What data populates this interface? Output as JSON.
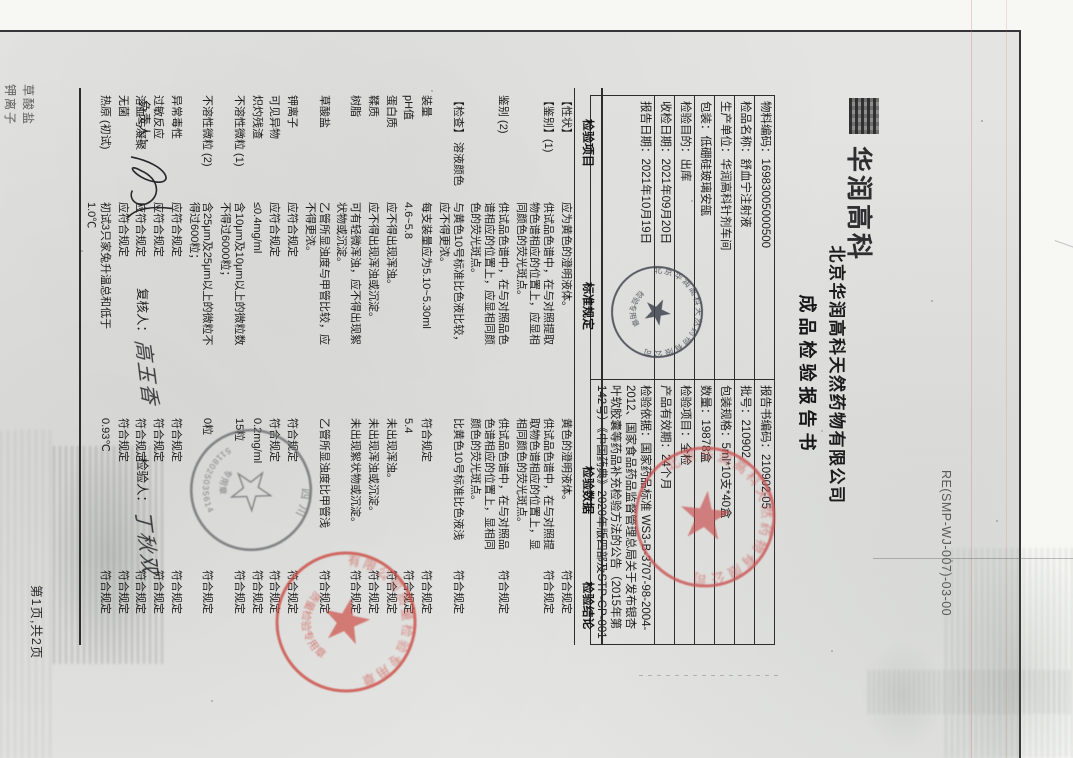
{
  "header": {
    "logo_text": "华润高科",
    "company": "北京华润高科天然药物有限公司",
    "report_title": "成品检验报告书",
    "doc_code": "RE(SMP-WJ-007)-03-00"
  },
  "info_table": {
    "rows": [
      {
        "left": "物料编码：16983005000500",
        "right": "报告书编码：210902-05"
      },
      {
        "left": "检品名称：舒血宁注射液",
        "right": "批号：210902"
      },
      {
        "left": "生产单位：华润高科针剂车间",
        "right": "包装规格：5ml*10支*40盒"
      },
      {
        "left": "包装：低硼硅玻璃安瓿",
        "right": "数量：19878盒"
      },
      {
        "left": "检验目的：出库",
        "right": "检验项目：全检"
      },
      {
        "left": "收检日期：2021年09月20日",
        "right": "产品有效期：24个月"
      },
      {
        "left": "报告日期：2021年10月19日",
        "right": "检验依据：国家药品标准 WS3-B-3707-98-2004-2012、国家食品药品监督管理总局关于发布银杏叶软胶囊等药品补充检验方法的公告（2015年第142号）《中国药典》2020年版四部及STP-CP-001"
      }
    ]
  },
  "main_table": {
    "headers": [
      "检验项目",
      "标准规定",
      "检验数据",
      "检验结论"
    ],
    "rows": [
      {
        "item": "【性状】",
        "standard": "应为黄色的澄明液体。",
        "data": "黄色的澄明液体。",
        "conclusion": "符合规定"
      },
      {
        "item": "【鉴别】(1)",
        "standard": "供试品色谱中，在与对照提取物色谱相应的位置上，应显相同颜色的荧光斑点。",
        "data": "供试品色谱中，在与对照提取物色谱相应的位置上，显相同颜色的荧光斑点。",
        "conclusion": "符合规定"
      },
      {
        "item": "鉴别 (2)",
        "standard": "供试品色谱中，在与对照品色谱相应的位置上，应显相同颜色的荧光斑点。",
        "data": "供试品色谱中，在与对照品色谱相应的位置上，显相同颜色的荧光斑点。",
        "conclusion": "符合规定"
      },
      {
        "item": "【检查】\n溶液颜色",
        "standard": "与黄色10号标准比色液比较，应不得更浓。",
        "data": "比黄色10号标准比色液浅",
        "conclusion": "符合规定"
      },
      {
        "item": "装量",
        "standard": "每支装量应为5.10~5.30ml",
        "data": "符合规定",
        "conclusion": "符合规定"
      },
      {
        "item": "pH值",
        "standard": "4.6~5.8",
        "data": "5.4",
        "conclusion": "符合规定"
      },
      {
        "item": "蛋白质",
        "standard": "应不得出现浑浊。",
        "data": "未出现浑浊。",
        "conclusion": "符合规定"
      },
      {
        "item": "鞣质",
        "standard": "应不得出现浑浊或沉淀。",
        "data": "未出现浑浊或沉淀。",
        "conclusion": "符合规定"
      },
      {
        "item": "树脂",
        "standard": "可有轻微浑浊，应不得出现絮状物或沉淀。",
        "data": "未出现絮状物或沉淀。",
        "conclusion": "符合规定"
      },
      {
        "item": "草酸盐",
        "standard": "乙管所显浊度与甲管比较，应不得更浓。",
        "data": "乙管所显浊度比甲管浅",
        "conclusion": "符合规定"
      },
      {
        "item": "钾离子",
        "standard": "应符合规定",
        "data": "符合规定",
        "conclusion": "符合规定"
      },
      {
        "item": "可见异物",
        "standard": "应符合规定",
        "data": "符合规定",
        "conclusion": "符合规定"
      },
      {
        "item": "炽灼残渣",
        "standard": "≤0.4mg/ml",
        "data": "0.2mg/ml",
        "conclusion": "符合规定"
      },
      {
        "item": "不溶性微粒 (1)",
        "standard": "含10μm及10μm以上的微粒数不得过6000粒；",
        "data": "15粒",
        "conclusion": "符合规定"
      },
      {
        "item": "不溶性微粒 (2)",
        "standard": "含25μm及25μm以上的微粒不得过600粒；",
        "data": "0粒",
        "conclusion": "符合规定"
      },
      {
        "item": "异常毒性",
        "standard": "应符合规定",
        "data": "符合规定",
        "conclusion": "符合规定"
      },
      {
        "item": "过敏反应",
        "standard": "应符合规定",
        "data": "符合规定",
        "conclusion": "符合规定"
      },
      {
        "item": "溶血与凝聚",
        "standard": "应符合规定",
        "data": "符合规定",
        "conclusion": "符合规定"
      },
      {
        "item": "无菌",
        "standard": "应符合规定",
        "data": "符合规定",
        "conclusion": "符合规定"
      },
      {
        "item": "热原 (初试)",
        "standard": "初试3只家兔升温总和低于1.0℃",
        "data": "0.93℃",
        "conclusion": "符合规定"
      }
    ]
  },
  "signatures": {
    "responsible_label": "负责人：",
    "reviewer_label": "复核人：",
    "reviewer_name": "高玉香",
    "tester_label": "检验人：",
    "tester_name": "丁秋双"
  },
  "footer": {
    "page_note": "第1页,共2页"
  },
  "stamps": {
    "inspection": {
      "color": "#3f434d",
      "ring_text": "北京华润高科天然药物有限公司",
      "label": "检验专用章"
    },
    "red_top": {
      "color": "#c94f4f",
      "ring_text": "北京华润高科天然药物有限公司",
      "legibility": "blurred"
    },
    "gray": {
      "color": "#6b6d70",
      "region_text": "四川",
      "code": "5118025035614",
      "label": "专用章"
    },
    "red_bottom": {
      "color": "#cc4a42",
      "ring_text": "有限公司质量检验专用章",
      "label": "质量检验专用章",
      "legibility": "blurred"
    }
  },
  "ghost_text": {
    "line1": "草酸盐",
    "line2": "钾离子"
  }
}
